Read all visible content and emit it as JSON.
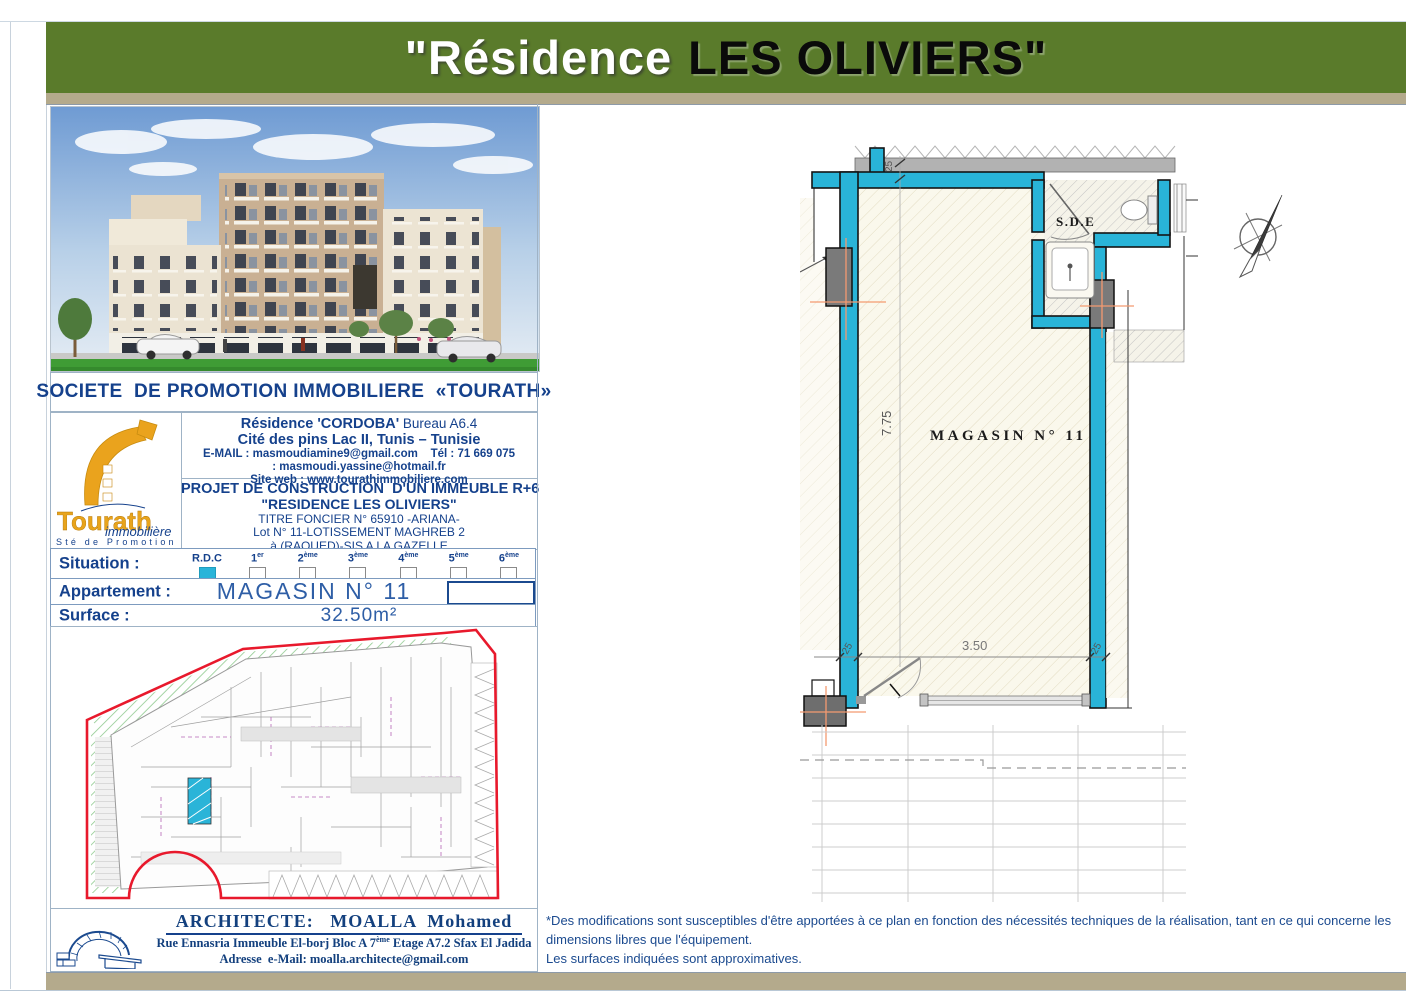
{
  "banner": {
    "title_white": "\"Résidence",
    "title_black": "LES OLIVIERS\"",
    "bg_color": "#5a7b2b"
  },
  "company": {
    "header": "SOCIETE  DE PROMOTION IMMOBILIERE  «TOURATH»",
    "logo": {
      "wordmark": "Tourath",
      "script": "immobilière",
      "subtitle": "Sté de Promotion"
    },
    "address": {
      "line1_bold": "Résidence 'CORDOBA'",
      "line1_rest": " Bureau A6.4",
      "line2": "Cité des pins Lac II, Tunis – Tunisie",
      "email_label": "E-MAIL : ",
      "email1": "masmoudiamine9@gmail.com",
      "tel_label": "    Tél : ",
      "tel": "71 669 075",
      "email2": ": masmoudi.yassine@hotmail.fr",
      "web_label": "Site web : ",
      "web": "www.tourathimmobiliere.com"
    }
  },
  "project": {
    "line1": "PROJET DE CONSTRUCTION  D'UN IMMEUBLE R+6",
    "line2": "\"RESIDENCE LES OLIVIERS\"",
    "line3": "TITRE FONCIER N° 65910 -ARIANA-",
    "line4": "Lot N° 11-LOTISSEMENT MAGHREB 2",
    "line5": "à (RAOUED)-SIS A LA GAZELLE"
  },
  "details": {
    "situation_label": "Situation :",
    "floors": [
      {
        "label": "R.D.C",
        "sup": "",
        "checked": true,
        "box_class": "cb filled"
      },
      {
        "label": "1",
        "sup": "er",
        "checked": false,
        "box_class": "cb"
      },
      {
        "label": "2",
        "sup": "ème",
        "checked": false,
        "box_class": "cb"
      },
      {
        "label": "3",
        "sup": "ème",
        "checked": false,
        "box_class": "cb"
      },
      {
        "label": "4",
        "sup": "ème",
        "checked": false,
        "box_class": "cb"
      },
      {
        "label": "5",
        "sup": "ème",
        "checked": false,
        "box_class": "cb"
      },
      {
        "label": "6",
        "sup": "ème",
        "checked": false,
        "box_class": "cb"
      }
    ],
    "apartment_label": "Appartement :",
    "apartment_value": "MAGASIN N° 11",
    "surface_label": "Surface :",
    "surface_value": "32.50m²"
  },
  "plan": {
    "room_label": "MAGASIN  N°  11",
    "sde_label": "S.D.E",
    "dim_height": "7.75",
    "dim_width": "3.50",
    "dim_wall": "25",
    "wall_color": "#29b4d8",
    "column_color": "#7a7a7a",
    "axis_color": "#f49a70",
    "site_boundary_color": "#e8192c",
    "highlight_unit_color": "#29b4d8"
  },
  "architect": {
    "heading": "ARCHITECTE:   MOALLA  Mohamed",
    "line1_pre": "Rue Ennasria Immeuble El-borj Bloc A 7",
    "line1_sup": "ème",
    "line1_post": " Etage A7.2 Sfax El Jadida",
    "line2": "Adresse  e-Mail: moalla.architecte@gmail.com"
  },
  "disclaimer": {
    "line1": "*Des modifications sont susceptibles d'être apportées à ce plan en fonction des nécessités techniques de la réalisation, tant en ce qui concerne les dimensions libres que l'équipement.",
    "line2": "Les surfaces indiquées sont approximatives."
  }
}
